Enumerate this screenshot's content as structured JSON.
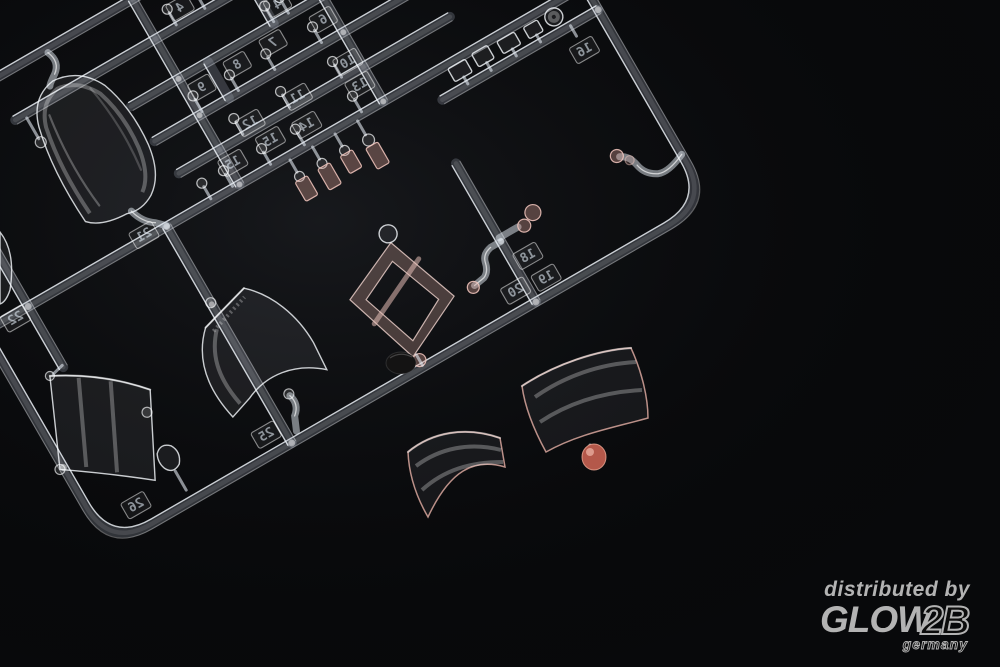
{
  "scene": {
    "subject": "Clear plastic injection-molded model kit sprue with canopy parts photographed on a black background",
    "background_color": "#08090b",
    "plastic_edge_color": "#eef2f7",
    "pink_tint_color": "#d9a79d",
    "red_gate_color": "#b4584a"
  },
  "sprue": {
    "part_number_tags": [
      "4",
      "4",
      "9",
      "8",
      "7",
      "6",
      "12",
      "11",
      "10",
      "15",
      "15",
      "14",
      "13",
      "16",
      "18",
      "20",
      "19",
      "21",
      "22",
      "25",
      "26"
    ],
    "note": "part numbers molded mirrored (sprue seen from reverse side)"
  },
  "watermark": {
    "line1": "distributed by",
    "brand_main": "GLOW",
    "brand_suffix": "2B",
    "country": "germany",
    "color": "#b3b3b3"
  }
}
